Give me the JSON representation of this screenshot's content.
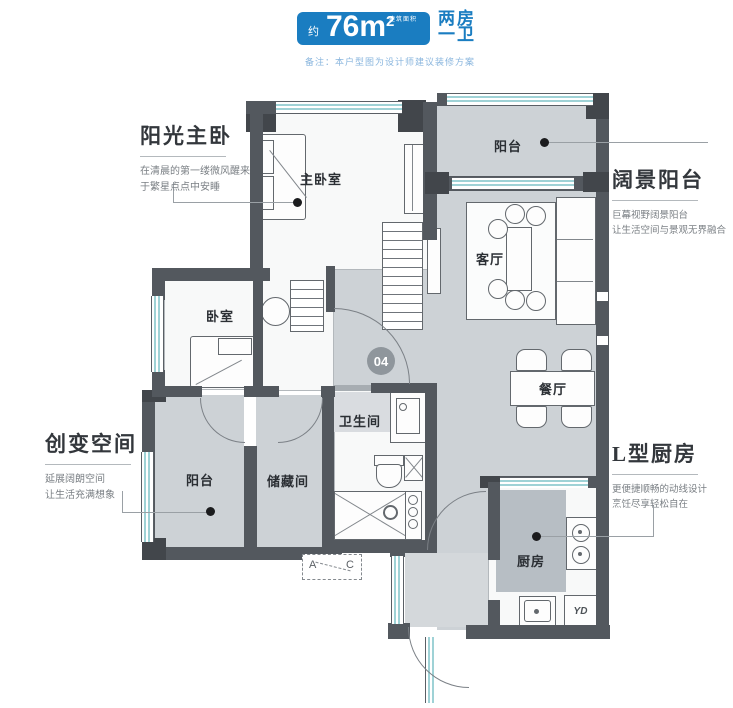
{
  "header": {
    "area_prefix": "约",
    "area_main": "76m",
    "area_exp": "2",
    "area_unit_note": "建筑面积",
    "layout_line1": "两房",
    "layout_line2": "一卫",
    "disclaimer": "备注：本户型图为设计师建议装修方案"
  },
  "callouts": {
    "master": {
      "title": "阳光主卧",
      "line1": "在清晨的第一缕微风醒来",
      "line2": "于繁星点点中安睡"
    },
    "view_balcony": {
      "title": "阔景阳台",
      "line1": "巨幕视野阔景阳台",
      "line2": "让生活空间与景观无界融合"
    },
    "flex_space": {
      "title": "创变空间",
      "line1": "延展阔朗空间",
      "line2": "让生活充满想象"
    },
    "kitchen": {
      "title": "L型厨房",
      "line1": "更便捷顺畅的动线设计",
      "line2": "烹饪尽享轻松自在"
    }
  },
  "rooms": {
    "master_bedroom": "主卧室",
    "bedroom": "卧室",
    "balcony_top": "阳台",
    "living": "客厅",
    "dining": "餐厅",
    "bathroom": "卫生间",
    "storage": "储藏间",
    "balcony_bottom": "阳台",
    "kitchen": "厨房"
  },
  "unit_number": "04",
  "appliance_label": "YD",
  "ac_marker": {
    "a": "A",
    "c": "C"
  },
  "colors": {
    "accent_blue": "#1a7dc1",
    "wall_gray": "#53585e",
    "floor_gray": "#cdd2d6",
    "window_teal": "#9fd2d6"
  }
}
